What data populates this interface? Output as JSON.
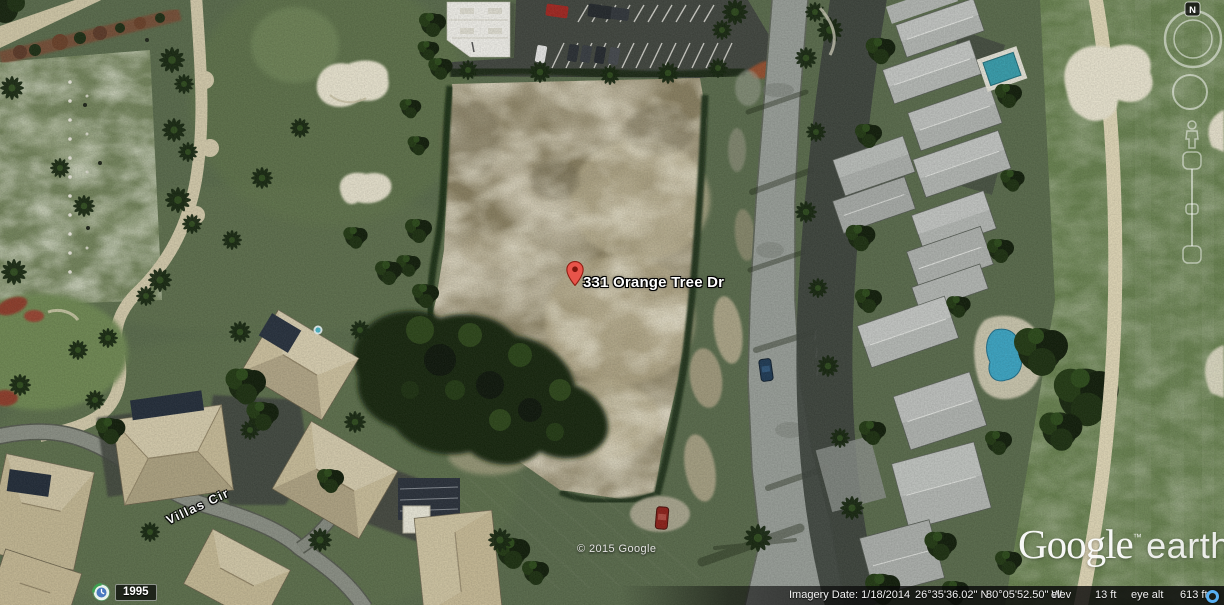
{
  "map_labels": {
    "placemark": "331 Orange Tree Dr",
    "street": "Villas Cir",
    "copyright": "© 2015 Google"
  },
  "logo": {
    "google": "Google",
    "trademark": "™",
    "earth": "earth"
  },
  "status_bar": {
    "imagery_date_label": "Imagery Date:",
    "imagery_date": "1/18/2014",
    "latitude": "26°35'36.02\" N",
    "longitude": "80°05'52.50\" W",
    "elev_label": "elev",
    "elevation": "13 ft",
    "eye_alt_label": "eye alt",
    "eye_altitude": "613 ft"
  },
  "time_control": {
    "oldest_imagery_year": "1995"
  },
  "navigation": {
    "north_label": "N"
  },
  "icons": {
    "streaming_indicator": "blue-ring",
    "historical_imagery": "clock",
    "placemark": "red-pin",
    "compass": "ring-with-N",
    "zoom_slider": "vertical-slider"
  },
  "colors": {
    "streaming_indicator": "#58b0f2",
    "placemark_red": "#e8544a",
    "label_text": "#ffffff",
    "status_text": "#f2f2f2"
  }
}
